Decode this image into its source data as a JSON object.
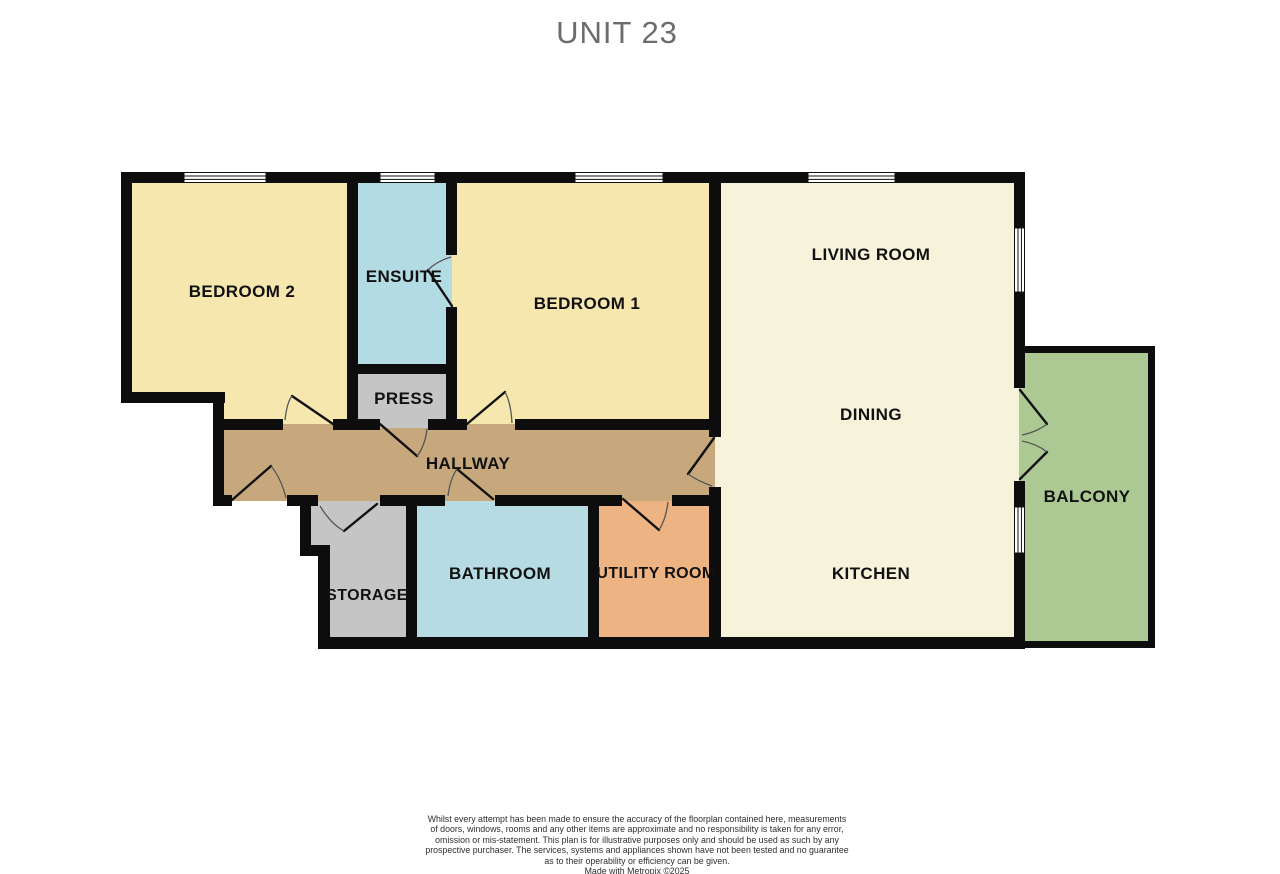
{
  "title": "UNIT 23",
  "rooms": {
    "bedroom2": {
      "label": "BEDROOM 2"
    },
    "ensuite": {
      "label": "ENSUITE"
    },
    "bedroom1": {
      "label": "BEDROOM 1"
    },
    "living": {
      "label": "LIVING ROOM"
    },
    "dining": {
      "label": "DINING"
    },
    "kitchen": {
      "label": "KITCHEN"
    },
    "balcony": {
      "label": "BALCONY"
    },
    "press": {
      "label": "PRESS"
    },
    "hallway": {
      "label": "HALLWAY"
    },
    "storage": {
      "label": "STORAGE"
    },
    "bathroom": {
      "label": "BATHROOM"
    },
    "utility": {
      "label": "UTILITY ROOM"
    }
  },
  "colors": {
    "bedroom": "#F6E7AF",
    "ensuite": "#B3DBE3",
    "bathroom": "#B6DBE3",
    "living": "#F7F3DA",
    "balcony": "#ACC993",
    "hallway": "#C7A87C",
    "storage": "#C6C5C5",
    "press": "#C6C5C5",
    "utility": "#EDB383",
    "wall": "#0d0d0d"
  },
  "disclaimer": {
    "line1": "Whilst every attempt has been made to ensure the accuracy of the floorplan contained here, measurements",
    "line2": "of doors, windows, rooms and any other items are approximate and no responsibility is taken for any error,",
    "line3": "omission or mis-statement. This plan is for illustrative purposes only and should be used as such by any",
    "line4": "prospective purchaser. The services, systems and appliances shown have not been tested and no guarantee",
    "line5": "as to their operability or efficiency can be given.",
    "credit": "Made with Metropix ©2025"
  }
}
